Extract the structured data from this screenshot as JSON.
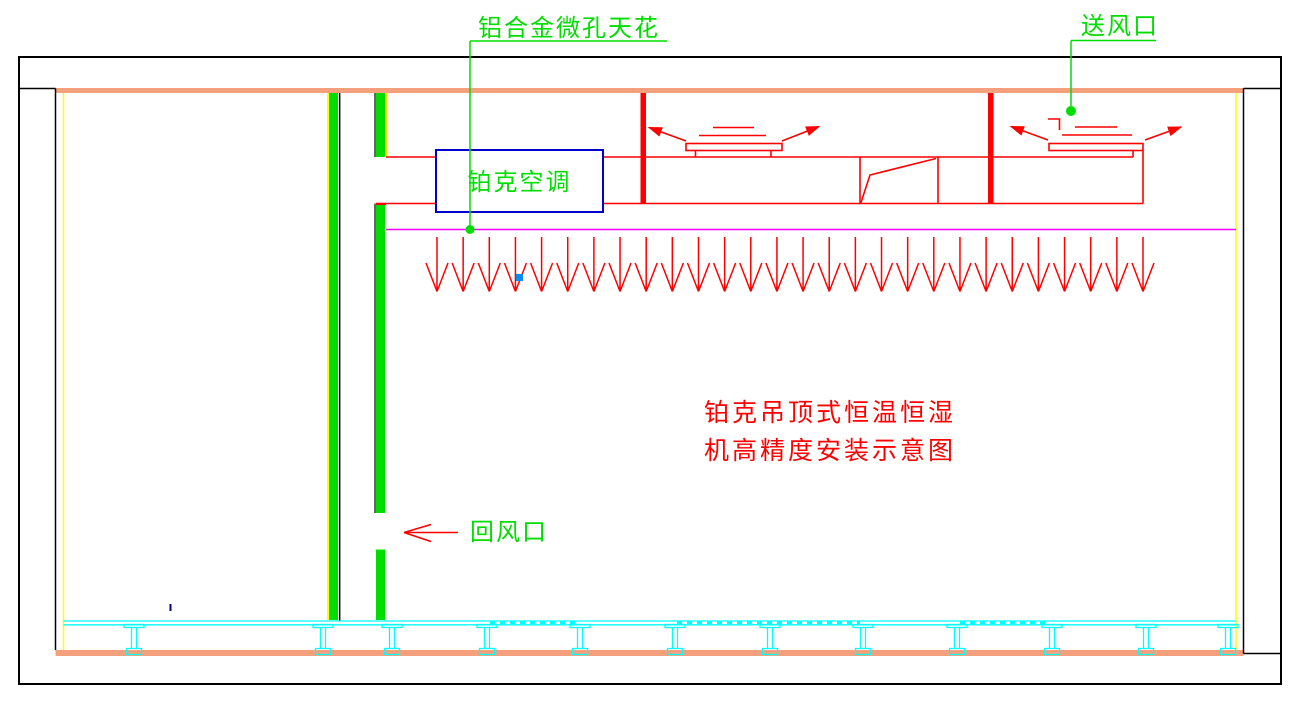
{
  "diagram": {
    "callouts": {
      "ceiling_label": "铝合金微孔天花",
      "supply_air_label": "送风口",
      "return_air_label": "回风口",
      "unit_label": "铂克空调",
      "caption_line1": "铂克吊顶式恒温恒湿",
      "caption_line2": "机高精度安装示意图"
    },
    "colors": {
      "wall_salmon": "#F5A07D",
      "cad_green": "#00DE00",
      "cad_red": "#FF0000",
      "cad_cyan": "#00FFFF",
      "cad_yellow": "#FFFF00",
      "cad_magenta": "#FF00FF",
      "unit_box_blue": "#0000CD",
      "marker_blue": "#0C8CF0",
      "tick_navy": "#00008B",
      "line_black": "#000000"
    },
    "airflow_arrows": {
      "count": 28,
      "x_start": 437,
      "x_end": 1143,
      "stem_top_y": 237,
      "tip_y": 291.5,
      "head_top_y": 263,
      "head_half_width": 11
    },
    "floor_pedestals": {
      "x_centers": [
        134,
        323,
        392,
        487,
        580,
        675,
        770,
        863,
        957,
        1052,
        1146,
        1228
      ],
      "flange_half_width": 10,
      "flange_top_y": 624.5,
      "flange_bottom_y": 627.5,
      "stem_half_width": 2.5,
      "stem_bottom_y": 648.5,
      "base_half_width": 7.5,
      "base_top_y": 648.5,
      "base_bottom_y": 654.5
    },
    "floor_dashed_segments": [
      [
        490,
        578
      ],
      [
        677,
        860
      ],
      [
        960,
        1049
      ]
    ],
    "floor_dash_y": 622.8
  }
}
